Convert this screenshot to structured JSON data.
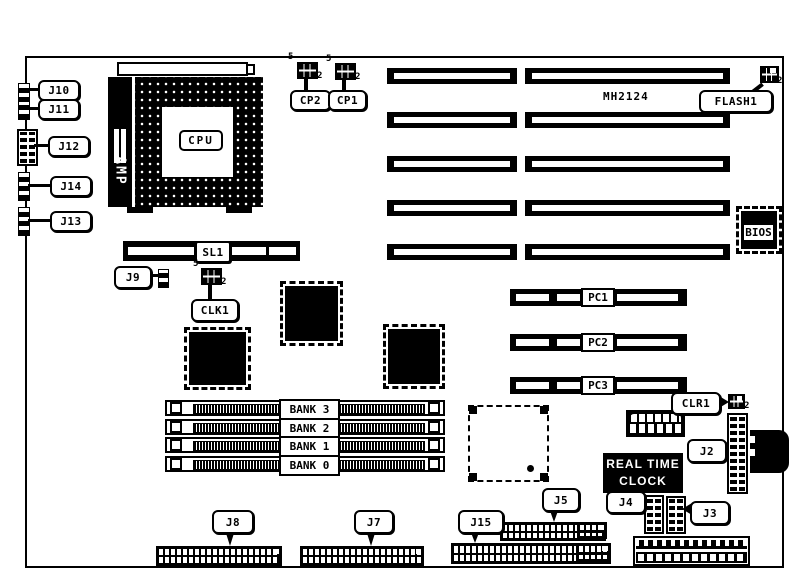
{
  "board": {
    "model": "MH2124"
  },
  "cpu": {
    "label": "CPU",
    "bracket": "AMP"
  },
  "left_connectors": [
    {
      "label": "J10"
    },
    {
      "label": "J11"
    },
    {
      "label": "J12"
    },
    {
      "label": "J14"
    },
    {
      "label": "J13"
    }
  ],
  "jumpers": {
    "cp2": {
      "label": "CP2",
      "pin_first": "5",
      "pin_last": "2"
    },
    "cp1": {
      "label": "CP1",
      "pin_first": "5",
      "pin_last": "2"
    },
    "clk1": {
      "label": "CLK1",
      "pin_first": "5",
      "pin_last": "2"
    },
    "flash1": {
      "label": "FLASH1",
      "pin_last": "2"
    },
    "clr1": {
      "label": "CLR1",
      "pin_last": "2"
    }
  },
  "slots": {
    "sl1": {
      "label": "SL1"
    },
    "pci": [
      {
        "label": "PC1"
      },
      {
        "label": "PC2"
      },
      {
        "label": "PC3"
      }
    ]
  },
  "memory_banks": [
    {
      "label": "BANK 3"
    },
    {
      "label": "BANK 2"
    },
    {
      "label": "BANK 1"
    },
    {
      "label": "BANK 0"
    }
  ],
  "chips": {
    "bios": {
      "label": "BIOS"
    },
    "rtc": {
      "line1": "REAL TIME",
      "line2": "CLOCK"
    }
  },
  "connectors": {
    "j9": {
      "label": "J9"
    },
    "j2": {
      "label": "J2"
    },
    "j4": {
      "label": "J4"
    },
    "j3": {
      "label": "J3"
    },
    "j5": {
      "label": "J5"
    },
    "j15": {
      "label": "J15"
    },
    "j8": {
      "label": "J8"
    },
    "j7": {
      "label": "J7"
    }
  }
}
